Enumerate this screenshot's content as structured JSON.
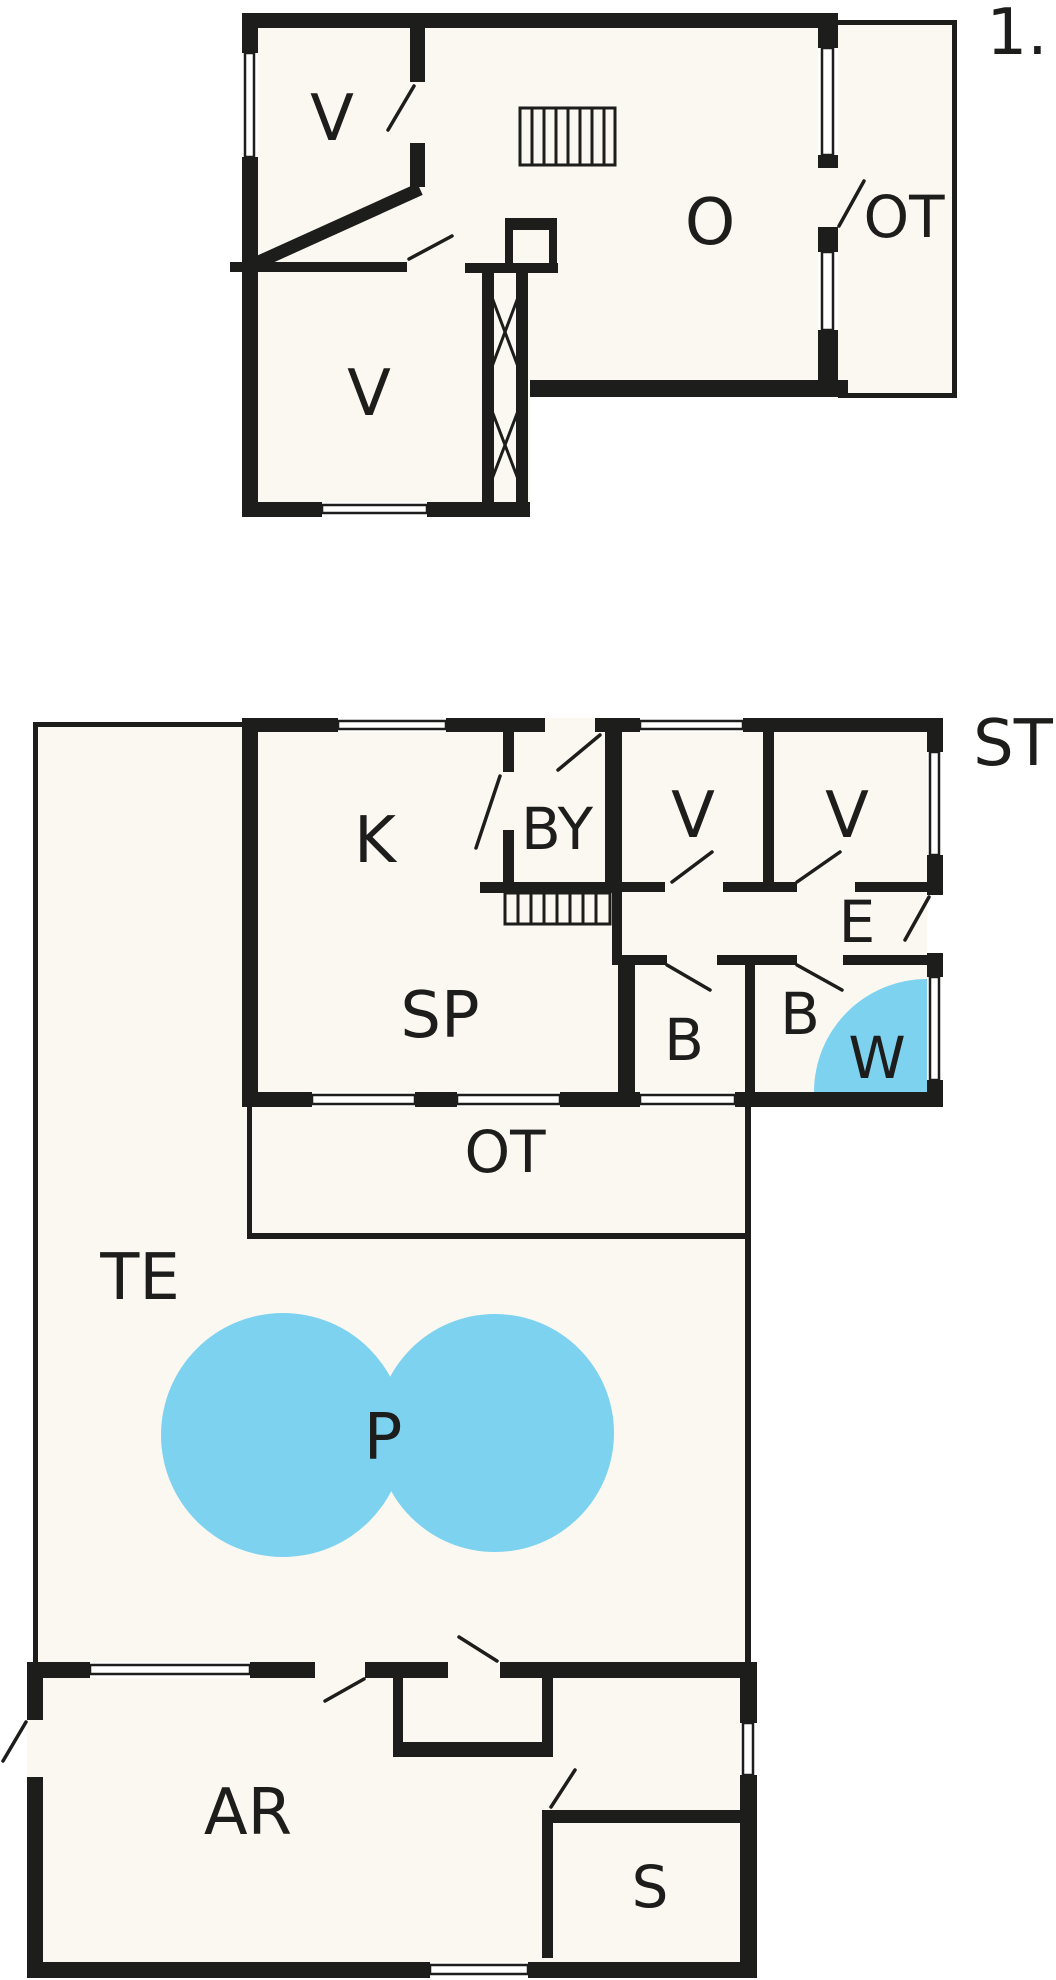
{
  "document": {
    "type": "house-floor-plan",
    "floors": [
      "upper",
      "ground"
    ]
  },
  "colors": {
    "wall": "#1d1d1b",
    "water": "#7dd2f0",
    "floor_fill": "#faf8f0",
    "page_background": "#ffffff"
  },
  "labels": {
    "floor_number": "1.",
    "upper_v1": "V",
    "upper_v2": "V",
    "upper_o": "O",
    "upper_ot": "OT",
    "k": "K",
    "by": "BY",
    "v1": "V",
    "v2": "V",
    "st": "ST",
    "e": "E",
    "sp": "SP",
    "b1": "B",
    "b2": "B",
    "w": "W",
    "ot": "OT",
    "te": "TE",
    "p": "P",
    "ar": "AR",
    "s": "S"
  },
  "rooms": [
    {
      "id": "upper_v1",
      "label": "V",
      "floor": "upper"
    },
    {
      "id": "upper_v2",
      "label": "V",
      "floor": "upper"
    },
    {
      "id": "upper_o",
      "label": "O",
      "floor": "upper"
    },
    {
      "id": "upper_ot",
      "label": "OT",
      "floor": "upper"
    },
    {
      "id": "k",
      "label": "K",
      "floor": "ground"
    },
    {
      "id": "by",
      "label": "BY",
      "floor": "ground"
    },
    {
      "id": "v1",
      "label": "V",
      "floor": "ground"
    },
    {
      "id": "v2",
      "label": "V",
      "floor": "ground"
    },
    {
      "id": "st",
      "label": "ST",
      "floor": "ground"
    },
    {
      "id": "e",
      "label": "E",
      "floor": "ground"
    },
    {
      "id": "sp",
      "label": "SP",
      "floor": "ground"
    },
    {
      "id": "b1",
      "label": "B",
      "floor": "ground"
    },
    {
      "id": "b2",
      "label": "B",
      "floor": "ground"
    },
    {
      "id": "w",
      "label": "W",
      "floor": "ground",
      "water": true
    },
    {
      "id": "ot",
      "label": "OT",
      "floor": "ground"
    },
    {
      "id": "te",
      "label": "TE",
      "floor": "ground"
    },
    {
      "id": "p",
      "label": "P",
      "floor": "ground",
      "water": true
    },
    {
      "id": "ar",
      "label": "AR",
      "floor": "ground"
    },
    {
      "id": "s",
      "label": "S",
      "floor": "ground"
    }
  ]
}
